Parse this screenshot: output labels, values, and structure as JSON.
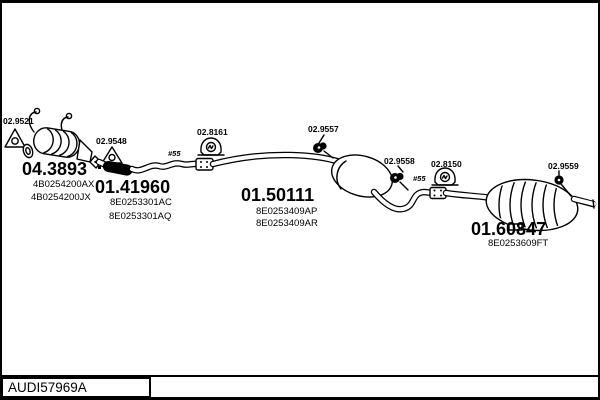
{
  "colors": {
    "ink": "#000000",
    "paper": "#ffffff"
  },
  "footer": {
    "drawing_code": "AUDI57969A"
  },
  "diagram": {
    "markers": {
      "front": "#55",
      "rear": "#55"
    },
    "parts": {
      "front_flange_gasket": {
        "ref": "02.9521"
      },
      "catalytic_converter": {
        "ref": "04.3893",
        "pn1": "4B0254200AX",
        "pn2": "4B0254200JX"
      },
      "cat_outlet_gasket": {
        "ref": "02.9548"
      },
      "front_pipe": {
        "ref": "01.41960",
        "pn1": "8E0253301AC",
        "pn2": "8E0253301AQ"
      },
      "front_hanger": {
        "ref": "02.8161"
      },
      "front_clamp": {
        "ref": "02.9557"
      },
      "centre_muffler": {
        "ref": "01.50111",
        "pn1": "8E0253409AP",
        "pn2": "8E0253409AR"
      },
      "mid_clamp": {
        "ref": "02.9558"
      },
      "rear_hanger": {
        "ref": "02.8150"
      },
      "tail_clamp": {
        "ref": "02.9559"
      },
      "rear_muffler": {
        "ref": "01.60847",
        "pn1": "8E0253609FT"
      }
    }
  }
}
